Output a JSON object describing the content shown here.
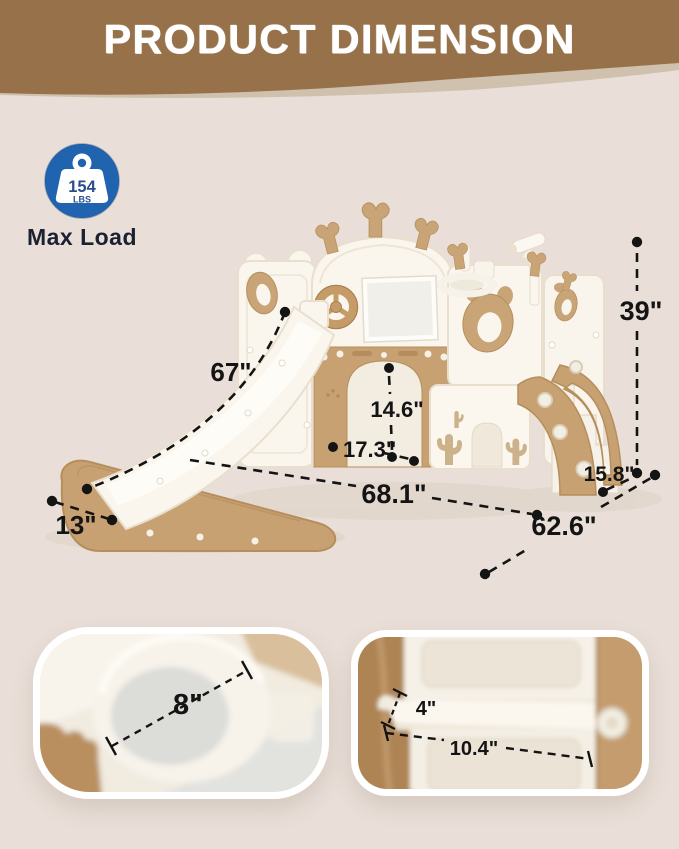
{
  "header": {
    "title": "PRODUCT DIMENSION"
  },
  "badge": {
    "icon": "weight-kettlebell-icon",
    "weight_value": "154",
    "weight_unit": "LBS",
    "label": "Max Load"
  },
  "diagram": {
    "dimensions": {
      "slide_length": "67\"",
      "overall_height": "39\"",
      "door_height": "14.6\"",
      "door_width": "17.3\"",
      "overall_width": "68.1\"",
      "stair_depth": "15.8\"",
      "slide_end_width": "13\"",
      "overall_depth": "62.6\""
    }
  },
  "detail_cards": {
    "hoop": {
      "ring_diameter": "8\""
    },
    "step": {
      "step_height": "4\"",
      "step_width": "10.4\""
    }
  },
  "colors": {
    "background": "#e9dfd8",
    "banner_brown": "#96714a",
    "banner_wave_tan": "#cfc1ad",
    "badge_blue": "#2063ae",
    "badge_number_blue": "#2a4d8f",
    "max_load_text": "#1b2130",
    "plastic_white": "#faf6ee",
    "plastic_tan": "#c8a173",
    "dimension_line": "#141414"
  }
}
